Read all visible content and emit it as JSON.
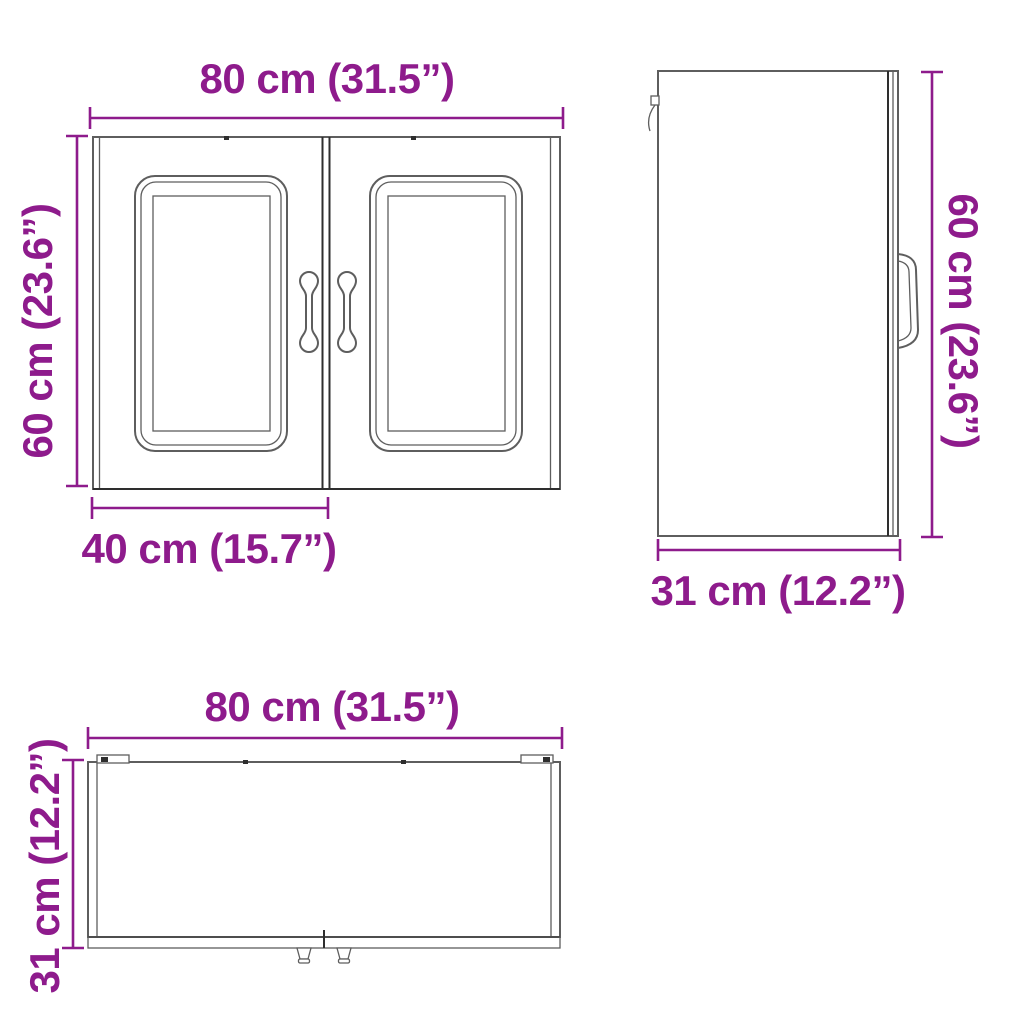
{
  "colors": {
    "accent": "#8E1B8C",
    "line": "#5E5E5E",
    "dark": "#2E2E2E",
    "background": "#FFFFFF"
  },
  "views": {
    "front": {
      "width_label": "80 cm (31.5”)",
      "height_label": "60 cm (23.6”)",
      "door_width_label": "40 cm (15.7”)"
    },
    "side": {
      "height_label": "60 cm (23.6”)",
      "depth_label": "31 cm (12.2”)"
    },
    "top": {
      "width_label": "80 cm (31.5”)",
      "depth_label": "31 cm (12.2”)"
    }
  }
}
